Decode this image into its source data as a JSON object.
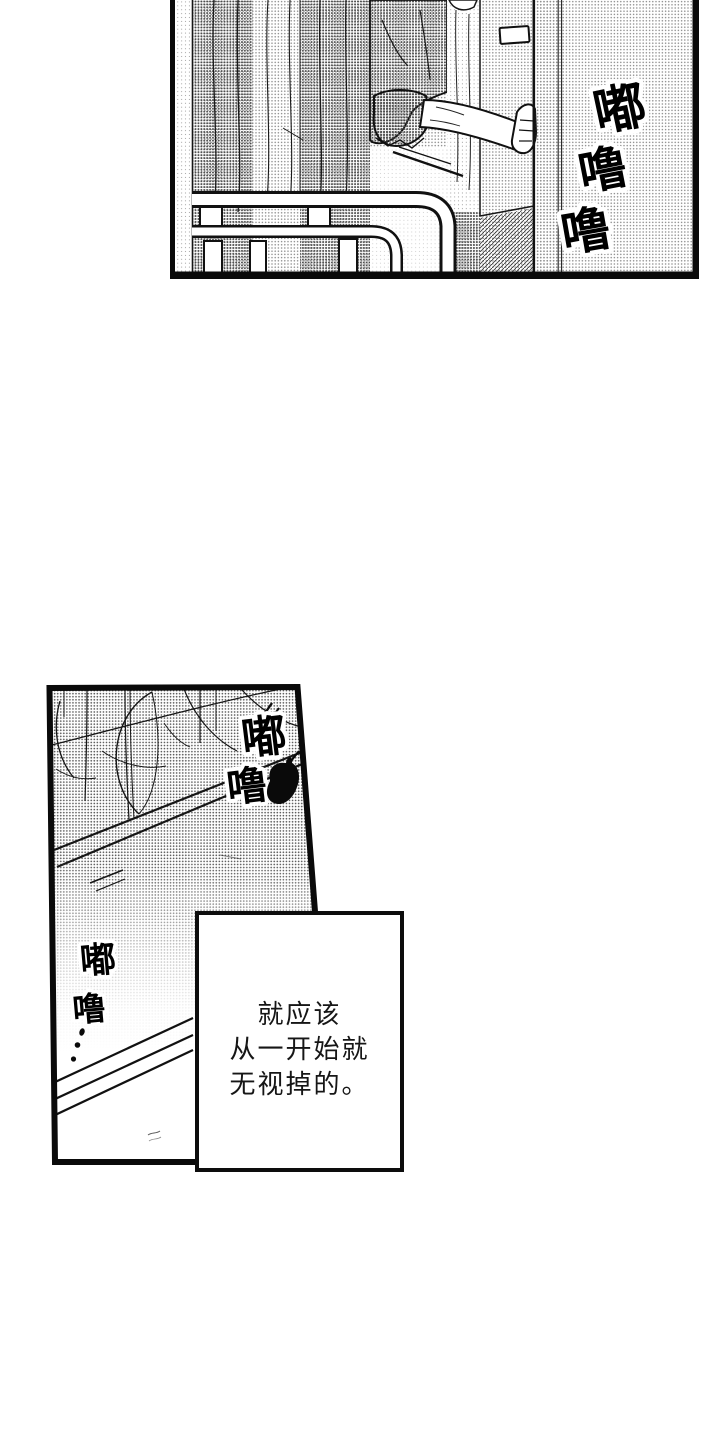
{
  "page": {
    "width": 720,
    "height": 1440,
    "background": "#ffffff"
  },
  "colors": {
    "ink": "#0d0d0d",
    "paper": "#ffffff",
    "halftone_gray": "#c9c9c9"
  },
  "top_panel": {
    "sfx_ring": {
      "chars": [
        "嘟",
        "噜",
        "噜"
      ]
    }
  },
  "bottom_panel": {
    "sfx_ring_near": {
      "chars": [
        "嘟",
        "噜"
      ]
    },
    "sfx_ring_far": {
      "chars": [
        "嘟",
        "噜"
      ],
      "trail": "…"
    },
    "dialogue_box": {
      "lines": [
        "就应该",
        "从一开始就",
        "无视掉的。"
      ]
    }
  }
}
